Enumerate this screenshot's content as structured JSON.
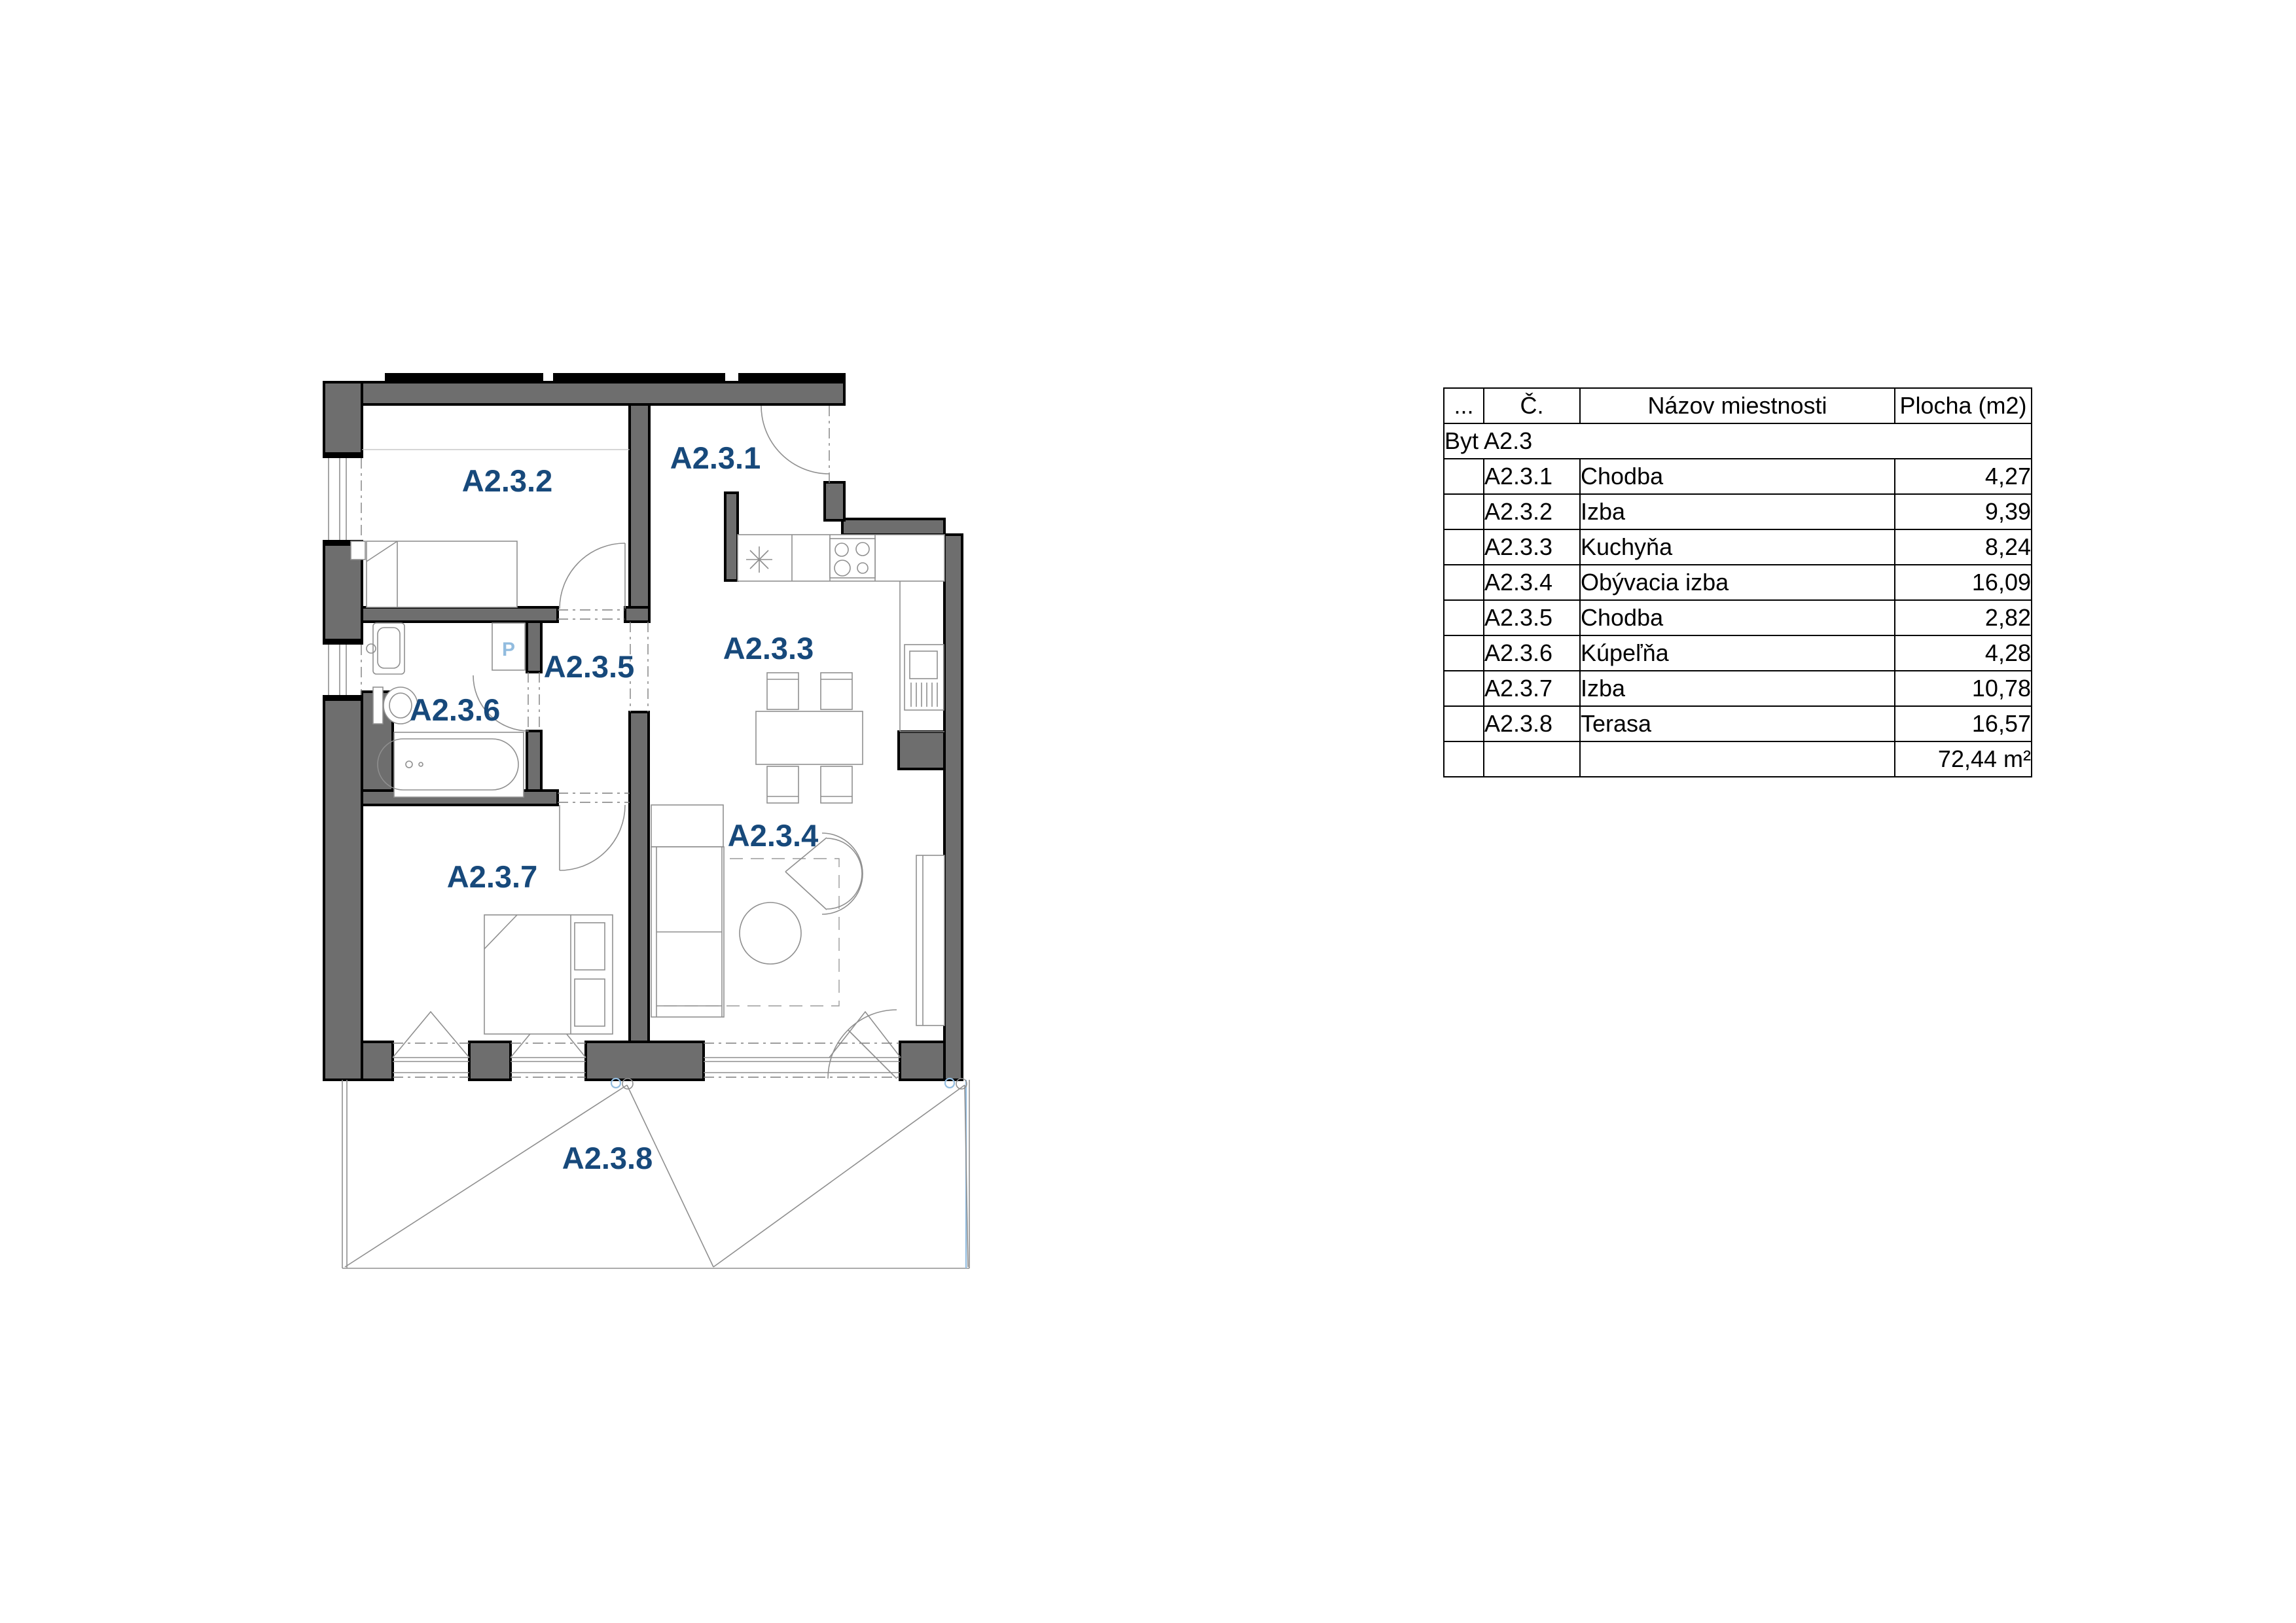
{
  "colors": {
    "wall_fill": "#6e6e6e",
    "label_color": "#17497b",
    "fixture_blue": "#92bcdf",
    "line_gray": "#8f8f8f"
  },
  "floorplan": {
    "rooms": [
      {
        "id": "A2.3.1",
        "name": "Chodba",
        "area": "4,27"
      },
      {
        "id": "A2.3.2",
        "name": "Izba",
        "area": "9,39"
      },
      {
        "id": "A2.3.3",
        "name": "Kuchyňa",
        "area": "8,24"
      },
      {
        "id": "A2.3.4",
        "name": "Obývacia izba",
        "area": "16,09"
      },
      {
        "id": "A2.3.5",
        "name": "Chodba",
        "area": "2,82"
      },
      {
        "id": "A2.3.6",
        "name": "Kúpeľňa",
        "area": "4,28"
      },
      {
        "id": "A2.3.7",
        "name": "Izba",
        "area": "10,78"
      },
      {
        "id": "A2.3.8",
        "name": "Terasa",
        "area": "16,57"
      }
    ],
    "washer_label": "P"
  },
  "table": {
    "headers": [
      "...",
      "Č.",
      "Názov miestnosti",
      "Plocha (m2)"
    ],
    "group_label": "Byt A2.3",
    "total_label": "72,44 m²"
  }
}
